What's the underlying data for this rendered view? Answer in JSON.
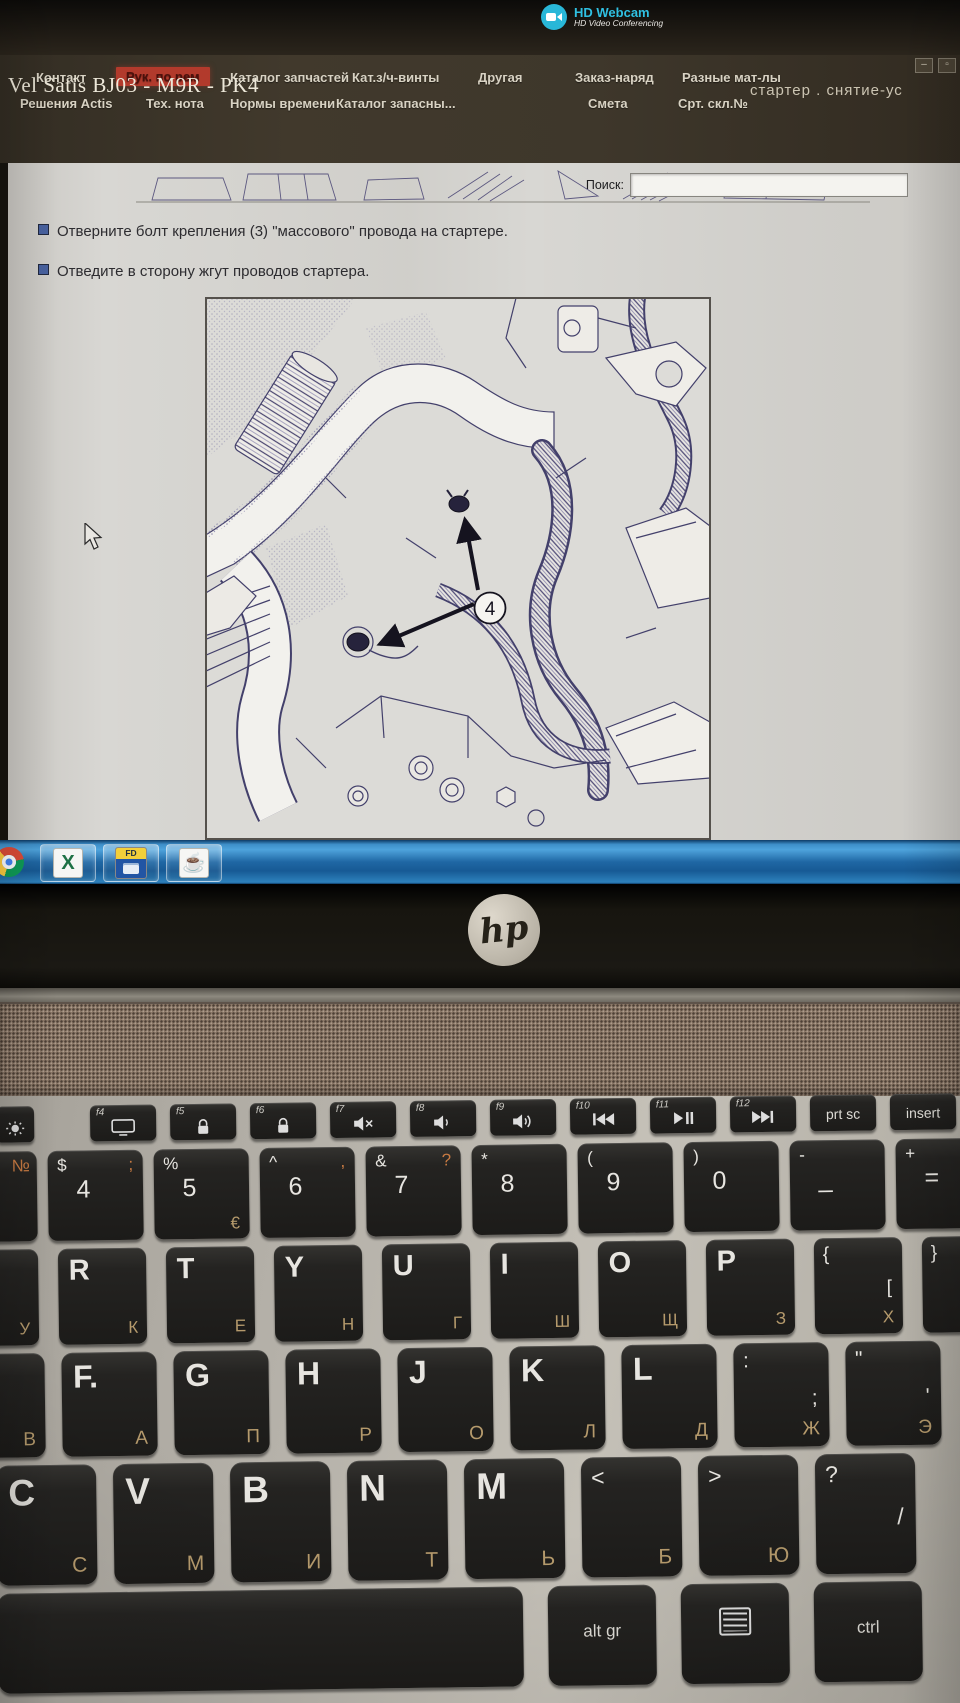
{
  "webcam": {
    "title": "HD Webcam",
    "subtitle": "HD Video Conferencing"
  },
  "app": {
    "menu_row1": [
      {
        "label": "Контакт",
        "active": false
      },
      {
        "label": "Рук. по рем",
        "active": true
      },
      {
        "label": "Каталог запчастей",
        "active": false
      },
      {
        "label": "Кат.з/ч-винты",
        "active": false
      },
      {
        "label": "Другая",
        "active": false
      },
      {
        "label": "Заказ-наряд",
        "active": false
      },
      {
        "label": "Разные мат-лы",
        "active": false
      }
    ],
    "menu_row2": [
      "Решения Actis",
      "Тех. нота",
      "Нормы времени",
      "Каталог запасны...",
      "Смета",
      "Срт. скл.№"
    ],
    "window_controls": {
      "minimize": "–",
      "restore": "▫"
    },
    "title": "Vel Satis BJ03 - M9R - PK4",
    "context": "стартер . снятие-ус",
    "search": {
      "label": "Поиск:",
      "value": "",
      "placeholder": ""
    },
    "steps": [
      "Отверните болт крепления (3) \"массового\" провода на стартере.",
      "Отведите в сторону жгут проводов стартера."
    ],
    "figure_label": "4"
  },
  "taskbar": {
    "icons": [
      "chrome",
      "excel",
      "fd-app",
      "java"
    ],
    "excel_glyph": "X",
    "fd_badge": "FD",
    "java_glyph": "☕"
  },
  "laptop": {
    "brand": "hp"
  },
  "keyboard": {
    "fn_row": [
      {
        "icon": "brightness"
      },
      {
        "f": "f4",
        "icon": "display"
      },
      {
        "f": "f5",
        "icon": "lock"
      },
      {
        "f": "f6",
        "icon": "lock"
      },
      {
        "f": "f7",
        "icon": "speaker-mute"
      },
      {
        "f": "f8",
        "icon": "speaker-low"
      },
      {
        "f": "f9",
        "icon": "speaker-high"
      },
      {
        "f": "f10",
        "icon": "prev-track"
      },
      {
        "f": "f11",
        "icon": "play-pause"
      },
      {
        "f": "f12",
        "icon": "next-track"
      },
      {
        "label": "prt sc"
      },
      {
        "label": "insert"
      }
    ],
    "num_row": [
      {
        "tr": "№"
      },
      {
        "tl": "$",
        "tr": ";",
        "main": "4"
      },
      {
        "tl": "%",
        "main": "5",
        "sub": "€"
      },
      {
        "tl": "^",
        "tr": ",",
        "main": "6"
      },
      {
        "tl": "&",
        "tr": "?",
        "main": "7"
      },
      {
        "tl": "*",
        "main": "8"
      },
      {
        "tl": "(",
        "main": "9"
      },
      {
        "tl": ")",
        "main": "0"
      },
      {
        "tl": "-",
        "main": "_"
      },
      {
        "tl": "+",
        "main": "="
      }
    ],
    "top_row": [
      {
        "main": "E",
        "sub": "У"
      },
      {
        "main": "R",
        "sub": "К"
      },
      {
        "main": "T",
        "sub": "Е"
      },
      {
        "main": "Y",
        "sub": "Н"
      },
      {
        "main": "U",
        "sub": "Г"
      },
      {
        "main": "I",
        "sub": "Ш"
      },
      {
        "main": "O",
        "sub": "Щ"
      },
      {
        "main": "P",
        "sub": "З"
      },
      {
        "tl": "{",
        "second": "[",
        "sub": "Х"
      },
      {
        "tl": "}",
        "second": "]"
      }
    ],
    "home_row": [
      {
        "sub": "В"
      },
      {
        "main": "F.",
        "sub": "А"
      },
      {
        "main": "G",
        "sub": "П"
      },
      {
        "main": "H",
        "sub": "Р"
      },
      {
        "main": "J",
        "sub": "О"
      },
      {
        "main": "K",
        "sub": "Л"
      },
      {
        "main": "L",
        "sub": "Д"
      },
      {
        "tl": ":",
        "second": ";",
        "sub": "Ж"
      },
      {
        "tl": "\"",
        "second": "'",
        "sub": "Э"
      }
    ],
    "bottom_row": [
      {
        "main": "C",
        "sub": "С"
      },
      {
        "main": "V",
        "sub": "М"
      },
      {
        "main": "B",
        "sub": "И"
      },
      {
        "main": "N",
        "sub": "Т"
      },
      {
        "main": "M",
        "sub": "Ь"
      },
      {
        "tl": "<",
        "sub": "Б"
      },
      {
        "tl": ">",
        "sub": "Ю"
      },
      {
        "tl": "?",
        "second": "/"
      }
    ],
    "space_row": [
      {
        "name": "space"
      },
      {
        "label": "alt gr"
      },
      {
        "icon": "menu",
        "name": "context-menu"
      },
      {
        "label": "ctrl"
      }
    ]
  }
}
